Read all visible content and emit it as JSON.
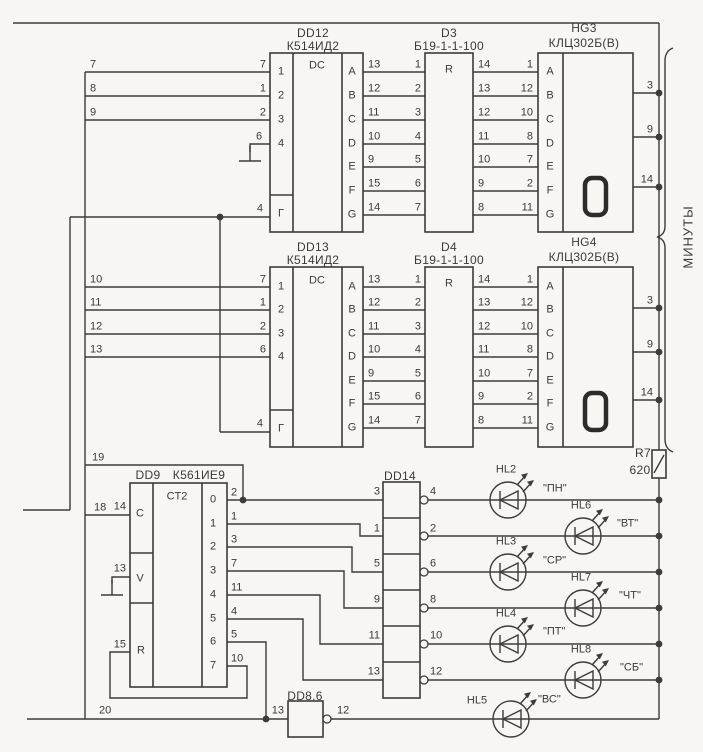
{
  "colors": {
    "bg": "#f7f6f2",
    "line": "#3b3b3b",
    "text": "#3a3a3a"
  },
  "group_label": "МИНУТЫ",
  "blocks": {
    "dd12": {
      "ref": "DD12",
      "type": "К514ИД2",
      "func": "DC"
    },
    "d3": {
      "ref": "D3",
      "type": "Б19-1-1-100",
      "func": "R"
    },
    "hg3": {
      "ref": "HG3",
      "type": "КЛЦ302Б(В)",
      "digit": "0"
    },
    "dd13": {
      "ref": "DD13",
      "type": "К514ИД2",
      "func": "DC"
    },
    "d4": {
      "ref": "D4",
      "type": "Б19-1-1-100",
      "func": "R"
    },
    "hg4": {
      "ref": "HG4",
      "type": "КЛЦ302Б(В)",
      "digit": "0"
    },
    "dd9": {
      "ref": "DD9",
      "type": "К561ИЕ9",
      "func": "CT2"
    },
    "dd14": {
      "ref": "DD14"
    },
    "dd86": {
      "ref": "DD8.6"
    },
    "r7": {
      "ref": "R7",
      "value": "620"
    }
  },
  "leds": [
    {
      "ref": "HL2",
      "label": "\"ПН\""
    },
    {
      "ref": "HL6",
      "label": "\"ВТ\""
    },
    {
      "ref": "HL3",
      "label": "\"СР\""
    },
    {
      "ref": "HL7",
      "label": "\"ЧТ\""
    },
    {
      "ref": "HL4",
      "label": "\"ПТ\""
    },
    {
      "ref": "HL8",
      "label": "\"СБ\""
    },
    {
      "ref": "HL5",
      "label": "\"ВС\""
    }
  ],
  "labels": [
    [
      "wire-number",
      "7",
      90,
      65,
      "l"
    ],
    [
      "wire-number",
      "8",
      90,
      89,
      "l"
    ],
    [
      "wire-number",
      "9",
      90,
      113,
      "l"
    ],
    [
      "pin-number",
      "7",
      266,
      65,
      "r"
    ],
    [
      "pin-number",
      "1",
      266,
      89,
      "r"
    ],
    [
      "pin-number",
      "2",
      266,
      113,
      "r"
    ],
    [
      "pin-number",
      "6",
      259,
      137,
      "c"
    ],
    [
      "pin-number",
      "4",
      263,
      209,
      "r"
    ],
    [
      "input-number",
      "1",
      281,
      72,
      "c"
    ],
    [
      "input-number",
      "2",
      281,
      96,
      "c"
    ],
    [
      "input-number",
      "3",
      281,
      120,
      "c"
    ],
    [
      "input-number",
      "4",
      281,
      144,
      "c"
    ],
    [
      "gate-label",
      "Г",
      281,
      214,
      "c"
    ],
    [
      "func-label",
      "DC",
      317,
      66,
      "c"
    ],
    [
      "seg-letter",
      "A",
      352,
      72,
      "c"
    ],
    [
      "seg-letter",
      "B",
      352,
      96,
      "c"
    ],
    [
      "seg-letter",
      "C",
      352,
      120,
      "c"
    ],
    [
      "seg-letter",
      "D",
      352,
      144,
      "c"
    ],
    [
      "seg-letter",
      "E",
      352,
      167,
      "c"
    ],
    [
      "seg-letter",
      "F",
      352,
      191,
      "c"
    ],
    [
      "seg-letter",
      "G",
      352,
      215,
      "c"
    ],
    [
      "pin-number",
      "13",
      368,
      65,
      "l"
    ],
    [
      "pin-number",
      "12",
      368,
      89,
      "l"
    ],
    [
      "pin-number",
      "11",
      368,
      113,
      "l"
    ],
    [
      "pin-number",
      "10",
      368,
      137,
      "l"
    ],
    [
      "pin-number",
      "9",
      368,
      160,
      "l"
    ],
    [
      "pin-number",
      "15",
      368,
      184,
      "l"
    ],
    [
      "pin-number",
      "14",
      368,
      208,
      "l"
    ],
    [
      "pin-number",
      "1",
      421,
      65,
      "r"
    ],
    [
      "pin-number",
      "2",
      421,
      89,
      "r"
    ],
    [
      "pin-number",
      "3",
      421,
      113,
      "r"
    ],
    [
      "pin-number",
      "4",
      421,
      137,
      "r"
    ],
    [
      "pin-number",
      "5",
      421,
      160,
      "r"
    ],
    [
      "pin-number",
      "6",
      421,
      184,
      "r"
    ],
    [
      "pin-number",
      "7",
      421,
      208,
      "r"
    ],
    [
      "func-label",
      "R",
      449,
      70,
      "c"
    ],
    [
      "pin-number",
      "14",
      478,
      65,
      "l"
    ],
    [
      "pin-number",
      "13",
      478,
      89,
      "l"
    ],
    [
      "pin-number",
      "12",
      478,
      113,
      "l"
    ],
    [
      "pin-number",
      "11",
      478,
      137,
      "l"
    ],
    [
      "pin-number",
      "10",
      478,
      160,
      "l"
    ],
    [
      "pin-number",
      "9",
      478,
      184,
      "l"
    ],
    [
      "pin-number",
      "8",
      478,
      208,
      "l"
    ],
    [
      "pin-number",
      "1",
      533,
      65,
      "r"
    ],
    [
      "pin-number",
      "12",
      533,
      89,
      "r"
    ],
    [
      "pin-number",
      "10",
      533,
      113,
      "r"
    ],
    [
      "pin-number",
      "8",
      533,
      137,
      "r"
    ],
    [
      "pin-number",
      "7",
      533,
      160,
      "r"
    ],
    [
      "pin-number",
      "2",
      533,
      184,
      "r"
    ],
    [
      "pin-number",
      "11",
      533,
      208,
      "r"
    ],
    [
      "seg-letter",
      "A",
      550,
      72,
      "c"
    ],
    [
      "seg-letter",
      "B",
      550,
      96,
      "c"
    ],
    [
      "seg-letter",
      "C",
      550,
      120,
      "c"
    ],
    [
      "seg-letter",
      "D",
      550,
      144,
      "c"
    ],
    [
      "seg-letter",
      "E",
      550,
      167,
      "c"
    ],
    [
      "seg-letter",
      "F",
      550,
      191,
      "c"
    ],
    [
      "seg-letter",
      "G",
      550,
      215,
      "c"
    ],
    [
      "pin-number",
      "3",
      653,
      86,
      "r"
    ],
    [
      "pin-number",
      "9",
      653,
      130,
      "r"
    ],
    [
      "pin-number",
      "14",
      653,
      180,
      "r"
    ],
    [
      "wire-number",
      "10",
      90,
      280,
      "l"
    ],
    [
      "wire-number",
      "11",
      90,
      303,
      "l"
    ],
    [
      "wire-number",
      "12",
      90,
      327,
      "l"
    ],
    [
      "wire-number",
      "13",
      90,
      350,
      "l"
    ],
    [
      "pin-number",
      "7",
      266,
      280,
      "r"
    ],
    [
      "pin-number",
      "1",
      266,
      303,
      "r"
    ],
    [
      "pin-number",
      "2",
      266,
      327,
      "r"
    ],
    [
      "pin-number",
      "6",
      266,
      350,
      "r"
    ],
    [
      "pin-number",
      "4",
      263,
      424,
      "r"
    ],
    [
      "input-number",
      "1",
      281,
      287,
      "c"
    ],
    [
      "input-number",
      "2",
      281,
      310,
      "c"
    ],
    [
      "input-number",
      "3",
      281,
      334,
      "c"
    ],
    [
      "input-number",
      "4",
      281,
      357,
      "c"
    ],
    [
      "gate-label",
      "Г",
      281,
      429,
      "c"
    ],
    [
      "func-label",
      "DC",
      317,
      281,
      "c"
    ],
    [
      "seg-letter",
      "A",
      352,
      287,
      "c"
    ],
    [
      "seg-letter",
      "B",
      352,
      310,
      "c"
    ],
    [
      "seg-letter",
      "C",
      352,
      334,
      "c"
    ],
    [
      "seg-letter",
      "D",
      352,
      357,
      "c"
    ],
    [
      "seg-letter",
      "E",
      352,
      381,
      "c"
    ],
    [
      "seg-letter",
      "F",
      352,
      404,
      "c"
    ],
    [
      "seg-letter",
      "G",
      352,
      428,
      "c"
    ],
    [
      "pin-number",
      "13",
      368,
      280,
      "l"
    ],
    [
      "pin-number",
      "12",
      368,
      303,
      "l"
    ],
    [
      "pin-number",
      "11",
      368,
      327,
      "l"
    ],
    [
      "pin-number",
      "10",
      368,
      350,
      "l"
    ],
    [
      "pin-number",
      "9",
      368,
      374,
      "l"
    ],
    [
      "pin-number",
      "15",
      368,
      397,
      "l"
    ],
    [
      "pin-number",
      "14",
      368,
      421,
      "l"
    ],
    [
      "pin-number",
      "1",
      421,
      280,
      "r"
    ],
    [
      "pin-number",
      "2",
      421,
      303,
      "r"
    ],
    [
      "pin-number",
      "3",
      421,
      327,
      "r"
    ],
    [
      "pin-number",
      "4",
      421,
      350,
      "r"
    ],
    [
      "pin-number",
      "5",
      421,
      374,
      "r"
    ],
    [
      "pin-number",
      "6",
      421,
      397,
      "r"
    ],
    [
      "pin-number",
      "7",
      421,
      421,
      "r"
    ],
    [
      "func-label",
      "R",
      449,
      284,
      "c"
    ],
    [
      "pin-number",
      "14",
      478,
      280,
      "l"
    ],
    [
      "pin-number",
      "13",
      478,
      303,
      "l"
    ],
    [
      "pin-number",
      "12",
      478,
      327,
      "l"
    ],
    [
      "pin-number",
      "11",
      478,
      350,
      "l"
    ],
    [
      "pin-number",
      "10",
      478,
      374,
      "l"
    ],
    [
      "pin-number",
      "9",
      478,
      397,
      "l"
    ],
    [
      "pin-number",
      "8",
      478,
      421,
      "l"
    ],
    [
      "pin-number",
      "1",
      533,
      280,
      "r"
    ],
    [
      "pin-number",
      "12",
      533,
      303,
      "r"
    ],
    [
      "pin-number",
      "10",
      533,
      327,
      "r"
    ],
    [
      "pin-number",
      "8",
      533,
      350,
      "r"
    ],
    [
      "pin-number",
      "7",
      533,
      374,
      "r"
    ],
    [
      "pin-number",
      "2",
      533,
      397,
      "r"
    ],
    [
      "pin-number",
      "11",
      533,
      421,
      "r"
    ],
    [
      "seg-letter",
      "A",
      550,
      287,
      "c"
    ],
    [
      "seg-letter",
      "B",
      550,
      310,
      "c"
    ],
    [
      "seg-letter",
      "C",
      550,
      334,
      "c"
    ],
    [
      "seg-letter",
      "D",
      550,
      357,
      "c"
    ],
    [
      "seg-letter",
      "E",
      550,
      381,
      "c"
    ],
    [
      "seg-letter",
      "F",
      550,
      404,
      "c"
    ],
    [
      "seg-letter",
      "G",
      550,
      428,
      "c"
    ],
    [
      "pin-number",
      "3",
      653,
      301,
      "r"
    ],
    [
      "pin-number",
      "9",
      653,
      345,
      "r"
    ],
    [
      "pin-number",
      "14",
      653,
      393,
      "r"
    ],
    [
      "wire-number",
      "19",
      92,
      458,
      "l"
    ],
    [
      "wire-number",
      "18",
      94,
      508,
      "l"
    ],
    [
      "wire-number",
      "20",
      99,
      711,
      "l"
    ],
    [
      "pin-number",
      "14",
      126,
      507,
      "r"
    ],
    [
      "pin-number",
      "13",
      126,
      569,
      "r"
    ],
    [
      "pin-number",
      "15",
      126,
      645,
      "r"
    ],
    [
      "input-letter",
      "C",
      140,
      514,
      "c"
    ],
    [
      "input-letter",
      "V",
      140,
      579,
      "c"
    ],
    [
      "input-letter",
      "R",
      141,
      651,
      "c"
    ],
    [
      "func-label",
      "CT2",
      177,
      497,
      "c"
    ],
    [
      "output-number",
      "0",
      213,
      500,
      "c"
    ],
    [
      "output-number",
      "1",
      213,
      524,
      "c"
    ],
    [
      "output-number",
      "2",
      213,
      547,
      "c"
    ],
    [
      "output-number",
      "3",
      213,
      571,
      "c"
    ],
    [
      "output-number",
      "4",
      213,
      595,
      "c"
    ],
    [
      "output-number",
      "5",
      213,
      619,
      "c"
    ],
    [
      "output-number",
      "6",
      213,
      642,
      "c"
    ],
    [
      "output-number",
      "7",
      213,
      666,
      "c"
    ],
    [
      "pin-number",
      "2",
      231,
      493,
      "l"
    ],
    [
      "pin-number",
      "1",
      231,
      517,
      "l"
    ],
    [
      "pin-number",
      "3",
      231,
      540,
      "l"
    ],
    [
      "pin-number",
      "7",
      231,
      564,
      "l"
    ],
    [
      "pin-number",
      "11",
      231,
      588,
      "l"
    ],
    [
      "pin-number",
      "4",
      231,
      612,
      "l"
    ],
    [
      "pin-number",
      "5",
      231,
      635,
      "l"
    ],
    [
      "pin-number",
      "10",
      231,
      659,
      "l"
    ],
    [
      "pin-number",
      "3",
      380,
      492,
      "r"
    ],
    [
      "pin-number",
      "1",
      380,
      529,
      "r"
    ],
    [
      "pin-number",
      "5",
      380,
      564,
      "r"
    ],
    [
      "pin-number",
      "9",
      380,
      600,
      "r"
    ],
    [
      "pin-number",
      "11",
      380,
      636,
      "r"
    ],
    [
      "pin-number",
      "13",
      380,
      672,
      "r"
    ],
    [
      "pin-number",
      "4",
      430,
      492,
      "l"
    ],
    [
      "pin-number",
      "2",
      430,
      529,
      "l"
    ],
    [
      "pin-number",
      "6",
      430,
      564,
      "l"
    ],
    [
      "pin-number",
      "8",
      430,
      600,
      "l"
    ],
    [
      "pin-number",
      "10",
      430,
      636,
      "l"
    ],
    [
      "pin-number",
      "12",
      430,
      672,
      "l"
    ],
    [
      "pin-number",
      "13",
      284,
      711,
      "r"
    ],
    [
      "pin-number",
      "12",
      337,
      711,
      "l"
    ]
  ]
}
